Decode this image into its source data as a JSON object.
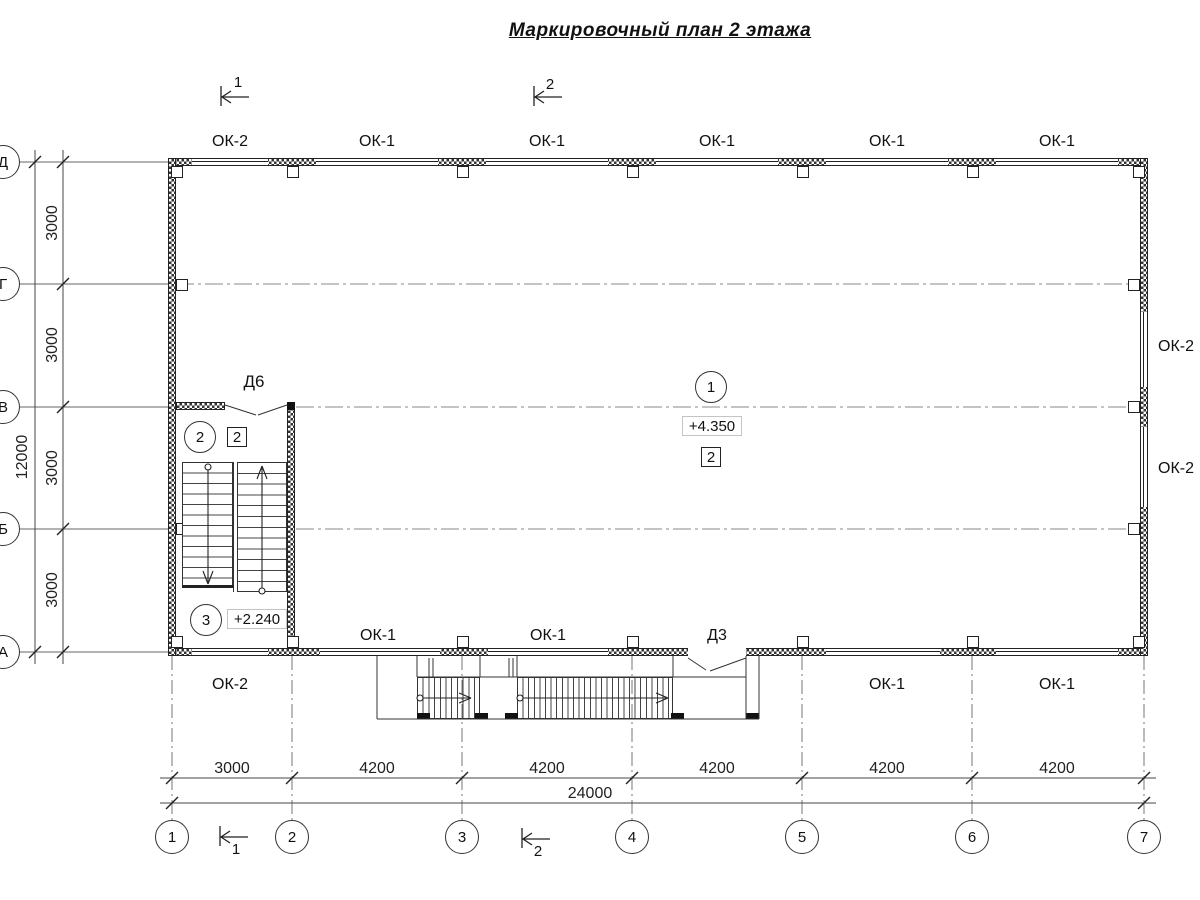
{
  "title": "Маркировочный план 2 этажа",
  "colors": {
    "line": "#333333",
    "axis": "#888888",
    "wall_hatch": "#333333"
  },
  "section_marks": {
    "top": [
      "1",
      "2"
    ],
    "bottom": [
      "1",
      "2"
    ]
  },
  "windows": {
    "top": [
      "ОК-2",
      "ОК-1",
      "ОК-1",
      "ОК-1",
      "ОК-1",
      "ОК-1"
    ],
    "bottom_inside": [
      "ОК-1",
      "ОК-1"
    ],
    "bottom_outside": [
      "ОК-2",
      "ОК-1",
      "ОК-1"
    ],
    "right": [
      "ОК-2",
      "ОК-2"
    ]
  },
  "doors": {
    "d6": "Д6",
    "d3": "Д3"
  },
  "rooms": {
    "hall": {
      "number": "1",
      "elevation": "+4.350",
      "finish_mark": "2"
    },
    "stair_landing": {
      "number": "2",
      "finish_mark": "2"
    },
    "stair_lower": {
      "number": "3",
      "elevation": "+2.240"
    }
  },
  "axes": {
    "letters": [
      "Д",
      "Г",
      "В",
      "Б",
      "А"
    ],
    "numbers": [
      "1",
      "2",
      "3",
      "4",
      "5",
      "6",
      "7"
    ],
    "left_dims": [
      "3000",
      "3000",
      "3000",
      "3000"
    ],
    "left_total": "12000",
    "bottom_dims": [
      "3000",
      "4200",
      "4200",
      "4200",
      "4200",
      "4200"
    ],
    "bottom_total": "24000"
  }
}
